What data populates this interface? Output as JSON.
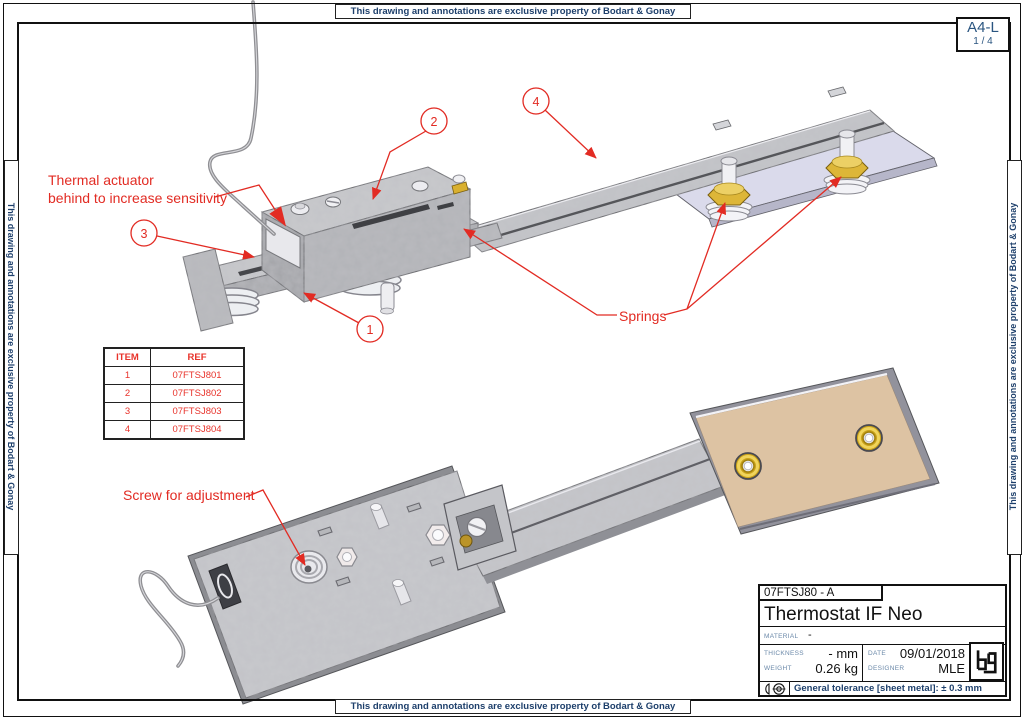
{
  "notices": {
    "property": "This drawing and annotations are exclusive property of Bodart & Gonay"
  },
  "sheet": {
    "format": "A4-L",
    "page": "1 / 4"
  },
  "annotations": {
    "thermal_line1": "Thermal actuator",
    "thermal_line2": "behind to increase sensitivity",
    "springs": "Springs",
    "screw": "Screw for adjustment",
    "balloon_1": "1",
    "balloon_2": "2",
    "balloon_3": "3",
    "balloon_4": "4"
  },
  "parts_table": {
    "headers": [
      "ITEM",
      "REF"
    ],
    "rows": [
      [
        "1",
        "07FTSJ801"
      ],
      [
        "2",
        "07FTSJ802"
      ],
      [
        "3",
        "07FTSJ803"
      ],
      [
        "4",
        "07FTSJ804"
      ]
    ]
  },
  "title_block": {
    "drawing_number": "07FTSJ80 - A",
    "title": "Thermostat IF Neo",
    "material_label": "MATERIAL",
    "material_value": "-",
    "thickness_label": "THICKNESS",
    "thickness_value": "- mm",
    "weight_label": "WEIGHT",
    "weight_value": "0.26 kg",
    "date_label": "DATE",
    "date_value": "09/01/2018",
    "designer_label": "DESIGNER",
    "designer_value": "MLE",
    "tolerance": "General tolerance [sheet metal]: ± 0.3 mm",
    "logo_icon": "bg-logo"
  },
  "colors": {
    "annotation_red": "#e22b23",
    "frame_navy": "#1d3f6b",
    "label_blue": "#6b89a9",
    "brass": "#d9b02f",
    "tan_plate": "#ddc3a3",
    "lavender_plate": "#dadaeb",
    "galvanized": "#c7c8cc"
  }
}
